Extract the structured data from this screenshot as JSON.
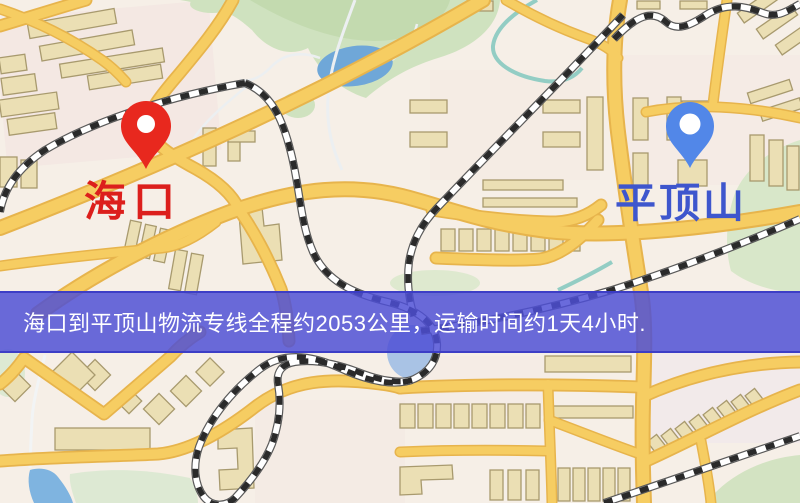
{
  "banner": {
    "text": "海口到平顶山物流专线全程约2053公里，运输时间约1天4小时.",
    "bg_color": "rgba(77,79,213,0.84)",
    "text_color": "#ffffff"
  },
  "markers": {
    "origin": {
      "label": "海口",
      "label_color": "#dc1f1c",
      "pin_color": "#e8281e",
      "icon": "map-pin-icon"
    },
    "destination": {
      "label": "平顶山",
      "label_color": "#3e56cd",
      "pin_color": "#5287e8",
      "icon": "map-pin-icon"
    }
  },
  "map_colors": {
    "background": "#f6efe7",
    "road_fill": "#f6cd62",
    "road_edge": "#e7b44c",
    "building": "#ebdfb4",
    "building_outline": "#a89a6e",
    "green_area": "#cfe2bf",
    "pale_green": "#dde9d3",
    "water": "#6fa7d8",
    "pond": "#7fb4e0",
    "railway_dash": "#2a2a2a",
    "railway_base": "#ffffff"
  }
}
